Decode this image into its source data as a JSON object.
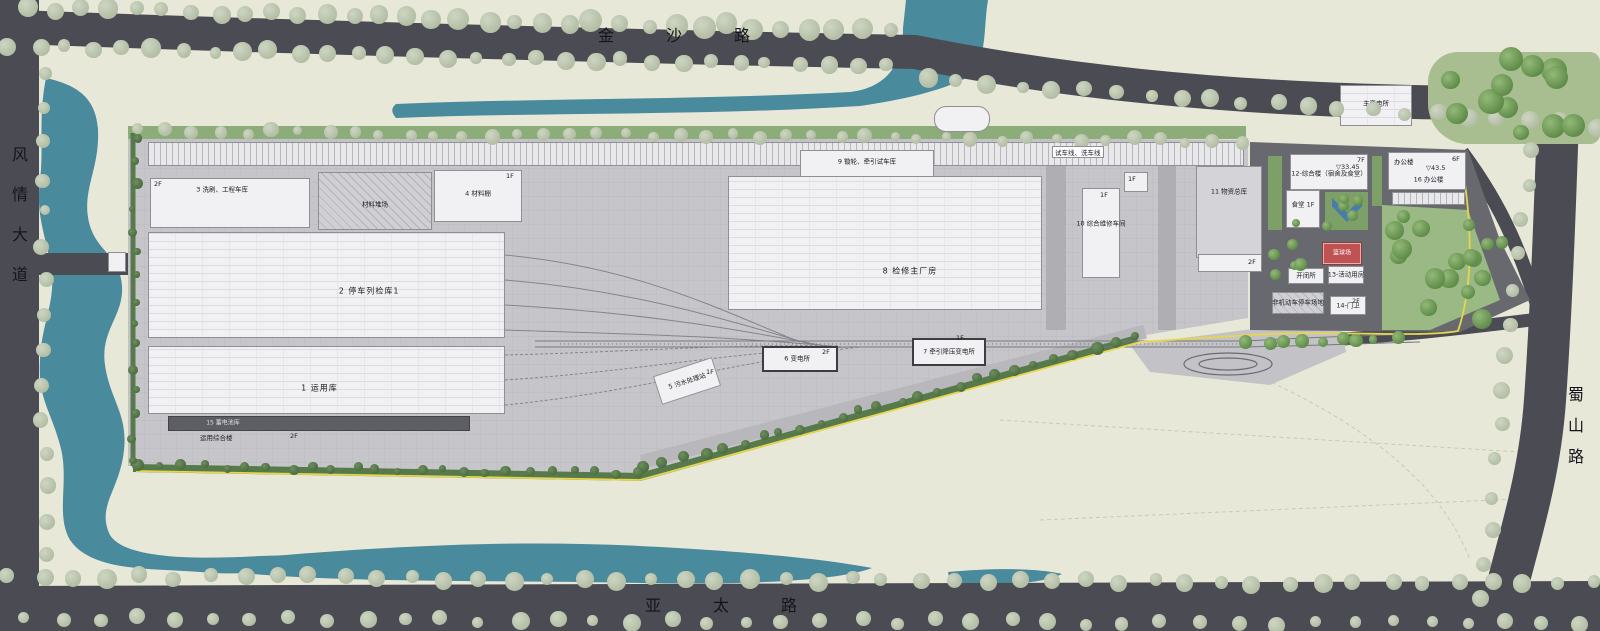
{
  "roads": {
    "north": "金沙路",
    "south": "亚太路",
    "west": "风情大道",
    "east": "蜀山路"
  },
  "colors": {
    "land": "#e8e8d9",
    "road": "#4b4b53",
    "water": "#4a8a9d",
    "site_slab": "#c6c6ca",
    "building": "#f1f1f3",
    "hedge_green": "#567a4c",
    "park_green": "#9ab984",
    "boundary_yellow": "#e7d54e",
    "court_red": "#bf5252",
    "pavilion_blue": "#4a7cab"
  },
  "buildings": [
    {
      "id": "test-track-shed",
      "label": "",
      "x": 148,
      "y": 142,
      "w": 1096,
      "h": 24,
      "type": "shed"
    },
    {
      "id": "washing-engineering-garage",
      "label": "3 洗刷、工程车库",
      "x": 150,
      "y": 178,
      "w": 160,
      "h": 50,
      "type": "plain",
      "lx": 45,
      "ly": 22
    },
    {
      "id": "material-yard",
      "label": "材料堆场",
      "x": 318,
      "y": 172,
      "w": 114,
      "h": 58,
      "type": "hatch",
      "lx": 50,
      "ly": 58
    },
    {
      "id": "material-shed",
      "label": "4 材料棚",
      "x": 434,
      "y": 170,
      "w": 88,
      "h": 52,
      "type": "plain",
      "lx": 50,
      "ly": 45
    },
    {
      "id": "parking-inspection-shed-1",
      "label": "2 停车列检库1",
      "x": 148,
      "y": 232,
      "w": 357,
      "h": 106,
      "type": "grid",
      "big": true,
      "lx": 62,
      "ly": 56
    },
    {
      "id": "operation-shed",
      "label": "1 运用库",
      "x": 148,
      "y": 346,
      "w": 357,
      "h": 68,
      "type": "grid",
      "big": true,
      "lx": 48,
      "ly": 62
    },
    {
      "id": "battery-shed",
      "label": "15 蓄电池库",
      "x": 168,
      "y": 416,
      "w": 302,
      "h": 15,
      "type": "dark",
      "lightlabel": true,
      "lx": 18,
      "ly": 50
    },
    {
      "id": "maintenance-main-workshop",
      "label": "8 检修主厂房",
      "x": 728,
      "y": 176,
      "w": 314,
      "h": 134,
      "type": "grid",
      "big": true,
      "lx": 58,
      "ly": 71
    },
    {
      "id": "wheel-lathe-test-shed",
      "label": "9 镟轮、牵引试车库",
      "x": 800,
      "y": 150,
      "w": 134,
      "h": 27,
      "type": "plain",
      "lx": 50,
      "ly": 45
    },
    {
      "id": "sewage-treatment",
      "label": "5 污水处理站",
      "x": 656,
      "y": 366,
      "w": 62,
      "h": 30,
      "type": "plain",
      "rot": -18,
      "lx": 50,
      "ly": 55
    },
    {
      "id": "substation-6",
      "label": "6 变电所",
      "x": 762,
      "y": 346,
      "w": 76,
      "h": 26,
      "type": "plain",
      "thick": true,
      "lx": 46,
      "ly": 50
    },
    {
      "id": "traction-substation",
      "label": "7 牵引降压变电所",
      "x": 912,
      "y": 338,
      "w": 74,
      "h": 28,
      "type": "plain",
      "thick": true,
      "lx": 50,
      "ly": 50
    },
    {
      "id": "comprehensive-maintenance-workshop",
      "label": "10 综合维修车间",
      "x": 1082,
      "y": 188,
      "w": 38,
      "h": 90,
      "type": "plain",
      "lx": 50,
      "ly": 40
    },
    {
      "id": "maintenance-annex",
      "label": "",
      "x": 1124,
      "y": 172,
      "w": 24,
      "h": 20,
      "type": "plain"
    },
    {
      "id": "materials-warehouse",
      "label": "11 物资总库",
      "x": 1196,
      "y": 166,
      "w": 66,
      "h": 92,
      "type": "gray",
      "lx": 50,
      "ly": 28
    },
    {
      "id": "warehouse-annex",
      "label": "",
      "x": 1198,
      "y": 254,
      "w": 64,
      "h": 18,
      "type": "plain"
    },
    {
      "id": "complex-building",
      "label": "12-综合楼（宿舍及食堂）",
      "x": 1290,
      "y": 154,
      "w": 78,
      "h": 36,
      "type": "plain",
      "lx": 50,
      "ly": 55
    },
    {
      "id": "canteen-annex",
      "label": "食堂 1F",
      "x": 1286,
      "y": 190,
      "w": 34,
      "h": 38,
      "type": "plain",
      "lx": 50,
      "ly": 40
    },
    {
      "id": "switch-station",
      "label": "开闭所",
      "x": 1288,
      "y": 268,
      "w": 36,
      "h": 16,
      "type": "plain",
      "lx": 50,
      "ly": 50
    },
    {
      "id": "activity-room",
      "label": "13-活动用房",
      "x": 1328,
      "y": 266,
      "w": 36,
      "h": 18,
      "type": "plain",
      "lx": 50,
      "ly": 50
    },
    {
      "id": "basketball-court",
      "label": "篮球场",
      "x": 1322,
      "y": 242,
      "w": 40,
      "h": 23,
      "type": "red",
      "whitelabel": true,
      "lx": 50,
      "ly": 50
    },
    {
      "id": "bicycle-parking",
      "label": "非机动车停车场地",
      "x": 1272,
      "y": 292,
      "w": 52,
      "h": 22,
      "type": "hatch",
      "lx": 50,
      "ly": 50
    },
    {
      "id": "gatehouse",
      "label": "14-门卫",
      "x": 1330,
      "y": 296,
      "w": 36,
      "h": 19,
      "type": "plain",
      "lx": 50,
      "ly": 55
    },
    {
      "id": "office-building",
      "label": "16 办公楼",
      "x": 1388,
      "y": 152,
      "w": 78,
      "h": 38,
      "type": "plain",
      "lx": 52,
      "ly": 74
    },
    {
      "id": "office-parking",
      "label": "",
      "x": 1392,
      "y": 192,
      "w": 73,
      "h": 13,
      "type": "shed"
    },
    {
      "id": "main-substation",
      "label": "主变电所",
      "x": 1340,
      "y": 85,
      "w": 72,
      "h": 41,
      "type": "grid",
      "lx": 50,
      "ly": 45
    },
    {
      "id": "bus-bay",
      "label": "",
      "x": 934,
      "y": 106,
      "w": 56,
      "h": 26,
      "type": "plain",
      "round": true
    },
    {
      "id": "west-gatehouse",
      "label": "",
      "x": 108,
      "y": 252,
      "w": 18,
      "h": 20,
      "type": "plain"
    }
  ],
  "tags": [
    {
      "t": "2F",
      "x": 154,
      "y": 180
    },
    {
      "t": "1F",
      "x": 506,
      "y": 172
    },
    {
      "t": "运用综合楼",
      "x": 200,
      "y": 432
    },
    {
      "t": "2F",
      "x": 290,
      "y": 432
    },
    {
      "t": "试车线、洗车线",
      "x": 1052,
      "y": 146,
      "chip": true
    },
    {
      "t": "1F",
      "x": 706,
      "y": 368
    },
    {
      "t": "2F",
      "x": 822,
      "y": 348
    },
    {
      "t": "1F",
      "x": 956,
      "y": 334
    },
    {
      "t": "1F",
      "x": 1100,
      "y": 191
    },
    {
      "t": "1F",
      "x": 1128,
      "y": 175
    },
    {
      "t": "2F",
      "x": 1248,
      "y": 258
    },
    {
      "t": "7F",
      "x": 1357,
      "y": 156
    },
    {
      "t": "▽33.45",
      "x": 1336,
      "y": 163
    },
    {
      "t": "办公楼",
      "x": 1394,
      "y": 156
    },
    {
      "t": "6F",
      "x": 1452,
      "y": 155
    },
    {
      "t": "▽43.5",
      "x": 1426,
      "y": 164
    },
    {
      "t": "2F",
      "x": 1352,
      "y": 297
    }
  ]
}
